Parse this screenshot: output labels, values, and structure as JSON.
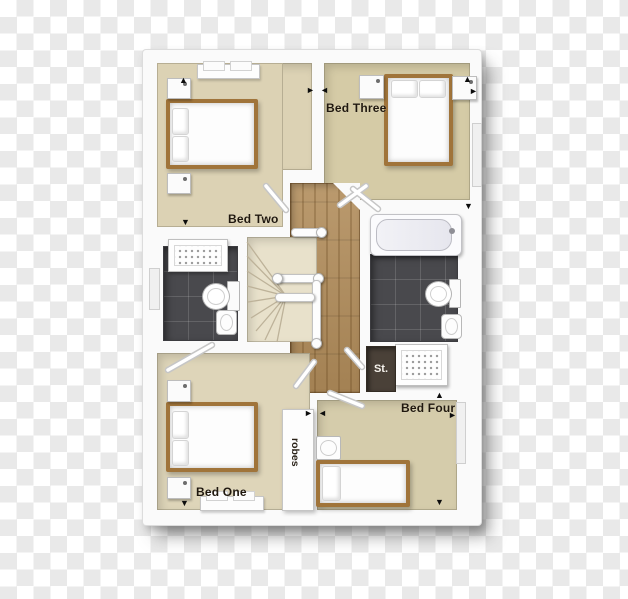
{
  "image_type": "house-first-floor-plan",
  "labels": {
    "bed_two": "Bed Two",
    "bed_three": "Bed Three",
    "bed_one": "Bed One",
    "bed_four": "Bed Four",
    "robes": "robes",
    "store": "St."
  },
  "arrows": {
    "up": "▲",
    "down": "▼",
    "left": "◄",
    "right": "►"
  },
  "palette": {
    "checker_light": "#ffffff",
    "checker_dark": "#e9e9e9",
    "wall": "#fafafa",
    "floor_bed_two": "#dcd2b4",
    "floor_bed_three": "#d5cba6",
    "floor_bed_one": "#ded5b9",
    "floor_bed_four": "#d5ccab",
    "stairs_floor": "#e8e1cb",
    "wood_landing": "#b18c5a",
    "tile_dark": "#49494d",
    "bed_frame": "#a0743a",
    "store_fill": "#4a4138",
    "label_text": "#20180e"
  }
}
